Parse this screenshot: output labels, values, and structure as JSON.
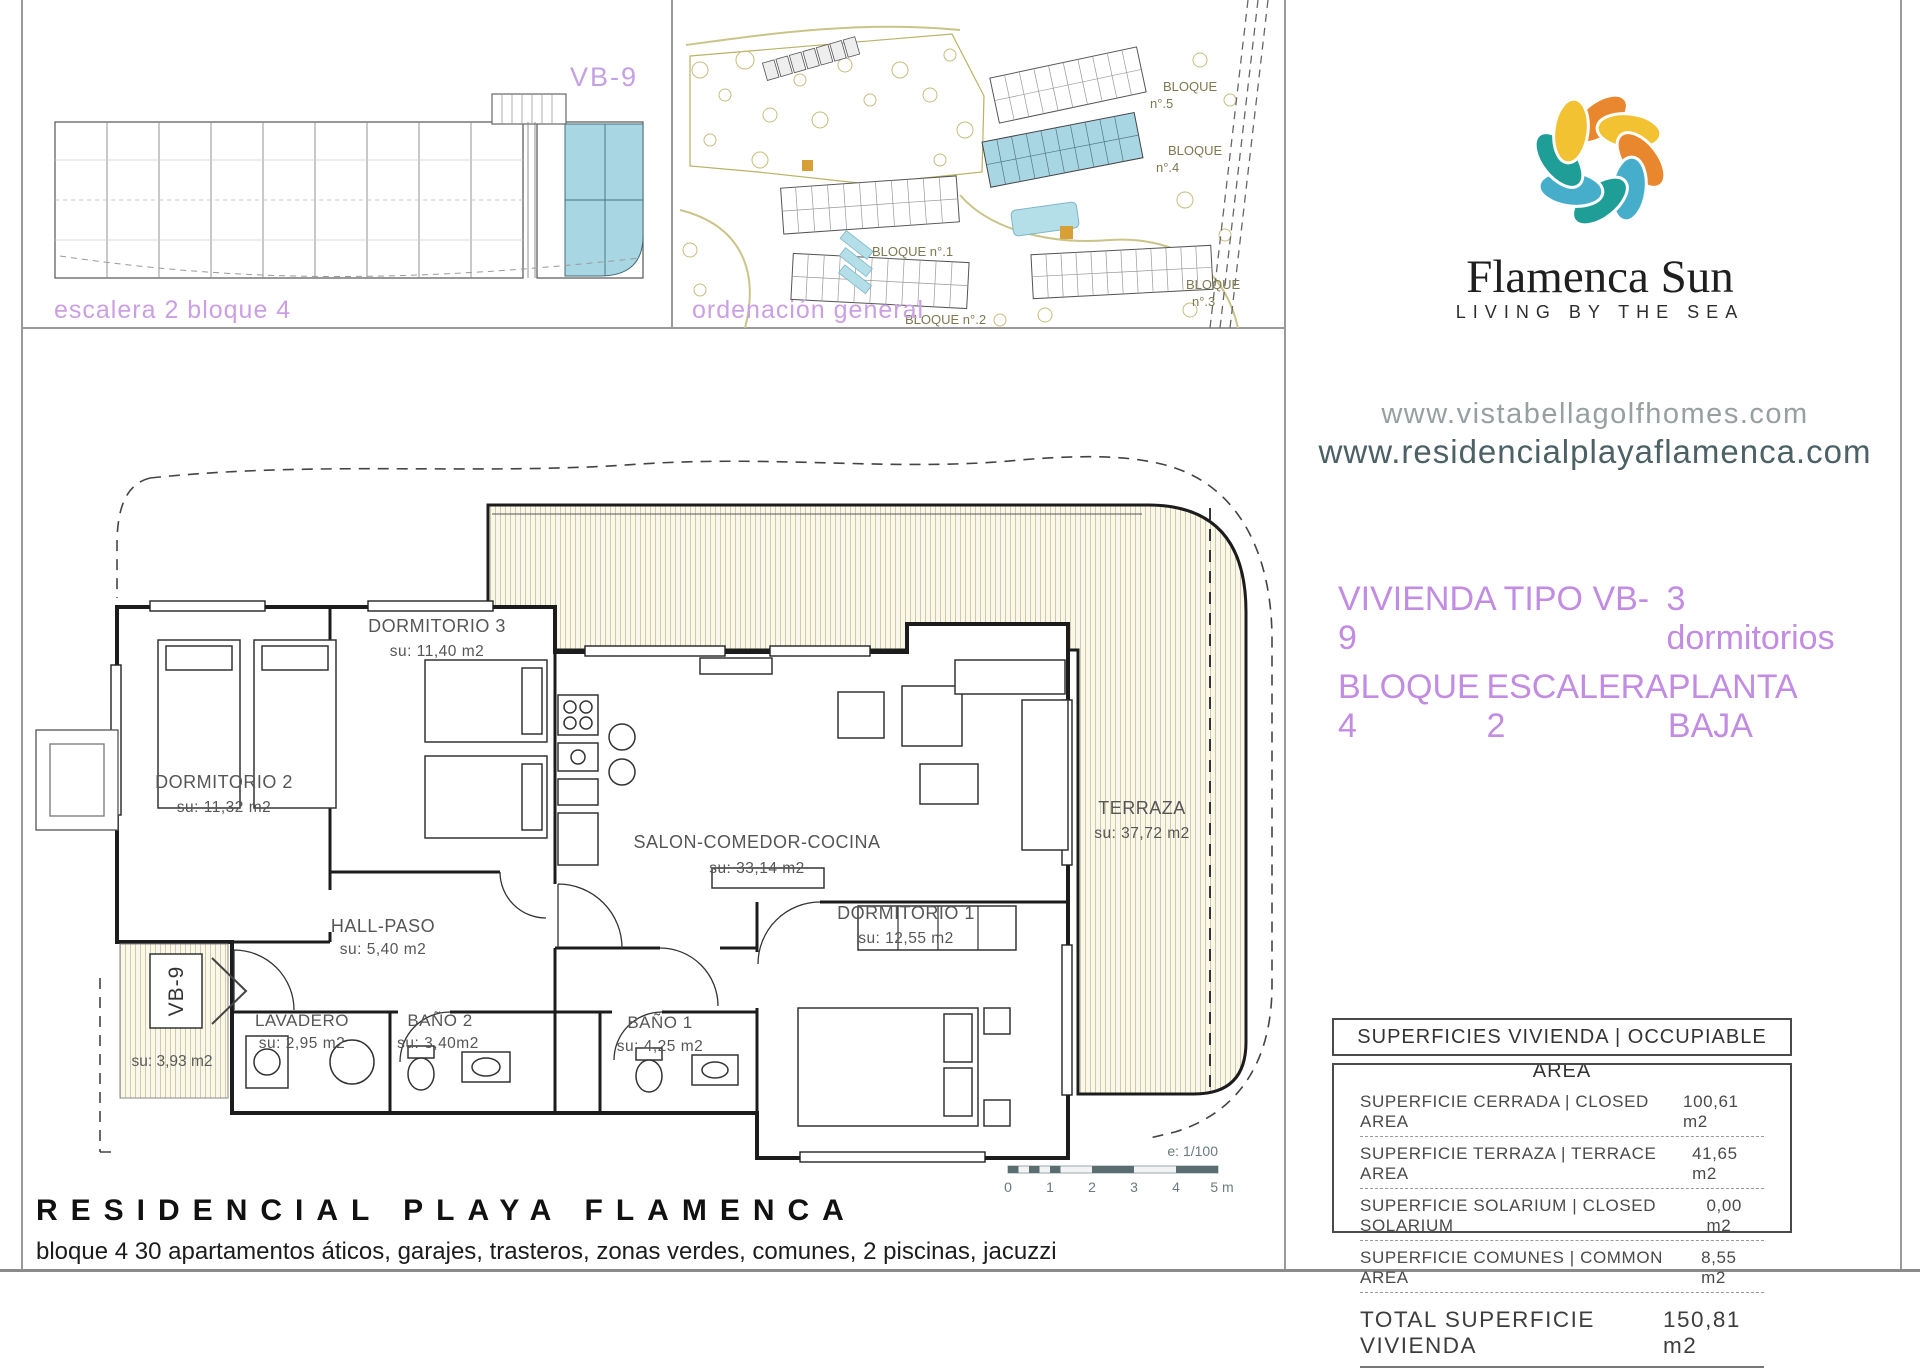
{
  "keyplan": {
    "caption": "escalera 2 bloque 4",
    "unit_label": "VB-9"
  },
  "siteplan": {
    "caption": "ordenación general",
    "labels": {
      "b5a": "BLOQUE",
      "b5b": "n°.5",
      "b4a": "BLOQUE",
      "b4b": "n°.4",
      "b1": "BLOQUE n°.1",
      "b2": "BLOQUE n°.2",
      "b3a": "BLOQUE",
      "b3b": "n°.3"
    }
  },
  "brand": {
    "name": "Flamenca Sun",
    "tagline": "LIVING BY THE SEA",
    "website_1": "www.vistabellagolfhomes.com",
    "website_2": "www.residencialplayaflamenca.com",
    "colors": {
      "yellow": "#f2c233",
      "orange": "#e8872e",
      "teal": "#1e9e96",
      "blue": "#46aecb",
      "purple": "#c18ce2",
      "highlight_blue": "#a9d6e3"
    }
  },
  "listing": {
    "type": "VIVIENDA TIPO VB-9",
    "bedrooms": "3 dormitorios",
    "block": "BLOQUE 4",
    "stair": "ESCALERA 2",
    "floor": "PLANTA BAJA"
  },
  "floor_plan": {
    "rooms": [
      {
        "name": "DORMITORIO 3",
        "area": "su: 11,40 m2"
      },
      {
        "name": "DORMITORIO 2",
        "area": "su: 11,32 m2"
      },
      {
        "name": "SALON-COMEDOR-COCINA",
        "area": "su: 33,14 m2"
      },
      {
        "name": "DORMITORIO 1",
        "area": "su: 12,55 m2"
      },
      {
        "name": "TERRAZA",
        "area": "su: 37,72 m2"
      },
      {
        "name": "HALL-PASO",
        "area": "su: 5,40 m2"
      },
      {
        "name": "LAVADERO",
        "area": "su: 2,95 m2"
      },
      {
        "name": "BAÑO 2",
        "area": "su: 3,40m2"
      },
      {
        "name": "BAÑO 1",
        "area": "su: 4,25 m2"
      },
      {
        "name": "VB-9",
        "area": "su: 3,93 m2"
      }
    ],
    "scale": {
      "label": "e: 1/100",
      "ticks": [
        "0",
        "1",
        "2",
        "3",
        "4",
        "5 m"
      ]
    }
  },
  "areas_table": {
    "header": "SUPERFICIES VIVIENDA | OCCUPIABLE AREA",
    "rows": [
      {
        "label": "SUPERFICIE CERRADA | CLOSED AREA",
        "value": "100,61 m2"
      },
      {
        "label": "SUPERFICIE TERRAZA   | TERRACE AREA",
        "value": "41,65 m2"
      },
      {
        "label": "SUPERFICIE SOLARIUM | CLOSED SOLARIUM",
        "value": "0,00 m2"
      },
      {
        "label": "SUPERFICIE COMUNES | COMMON AREA",
        "value": "8,55 m2"
      }
    ],
    "total": {
      "label": "TOTAL SUPERFICIE VIVIENDA",
      "value": "150,81 m2"
    }
  },
  "footer": {
    "title": "RESIDENCIAL PLAYA FLAMENCA",
    "subtitle": "bloque 4 30 apartamentos áticos, garajes, trasteros, zonas verdes, comunes, 2 piscinas, jacuzzi"
  }
}
